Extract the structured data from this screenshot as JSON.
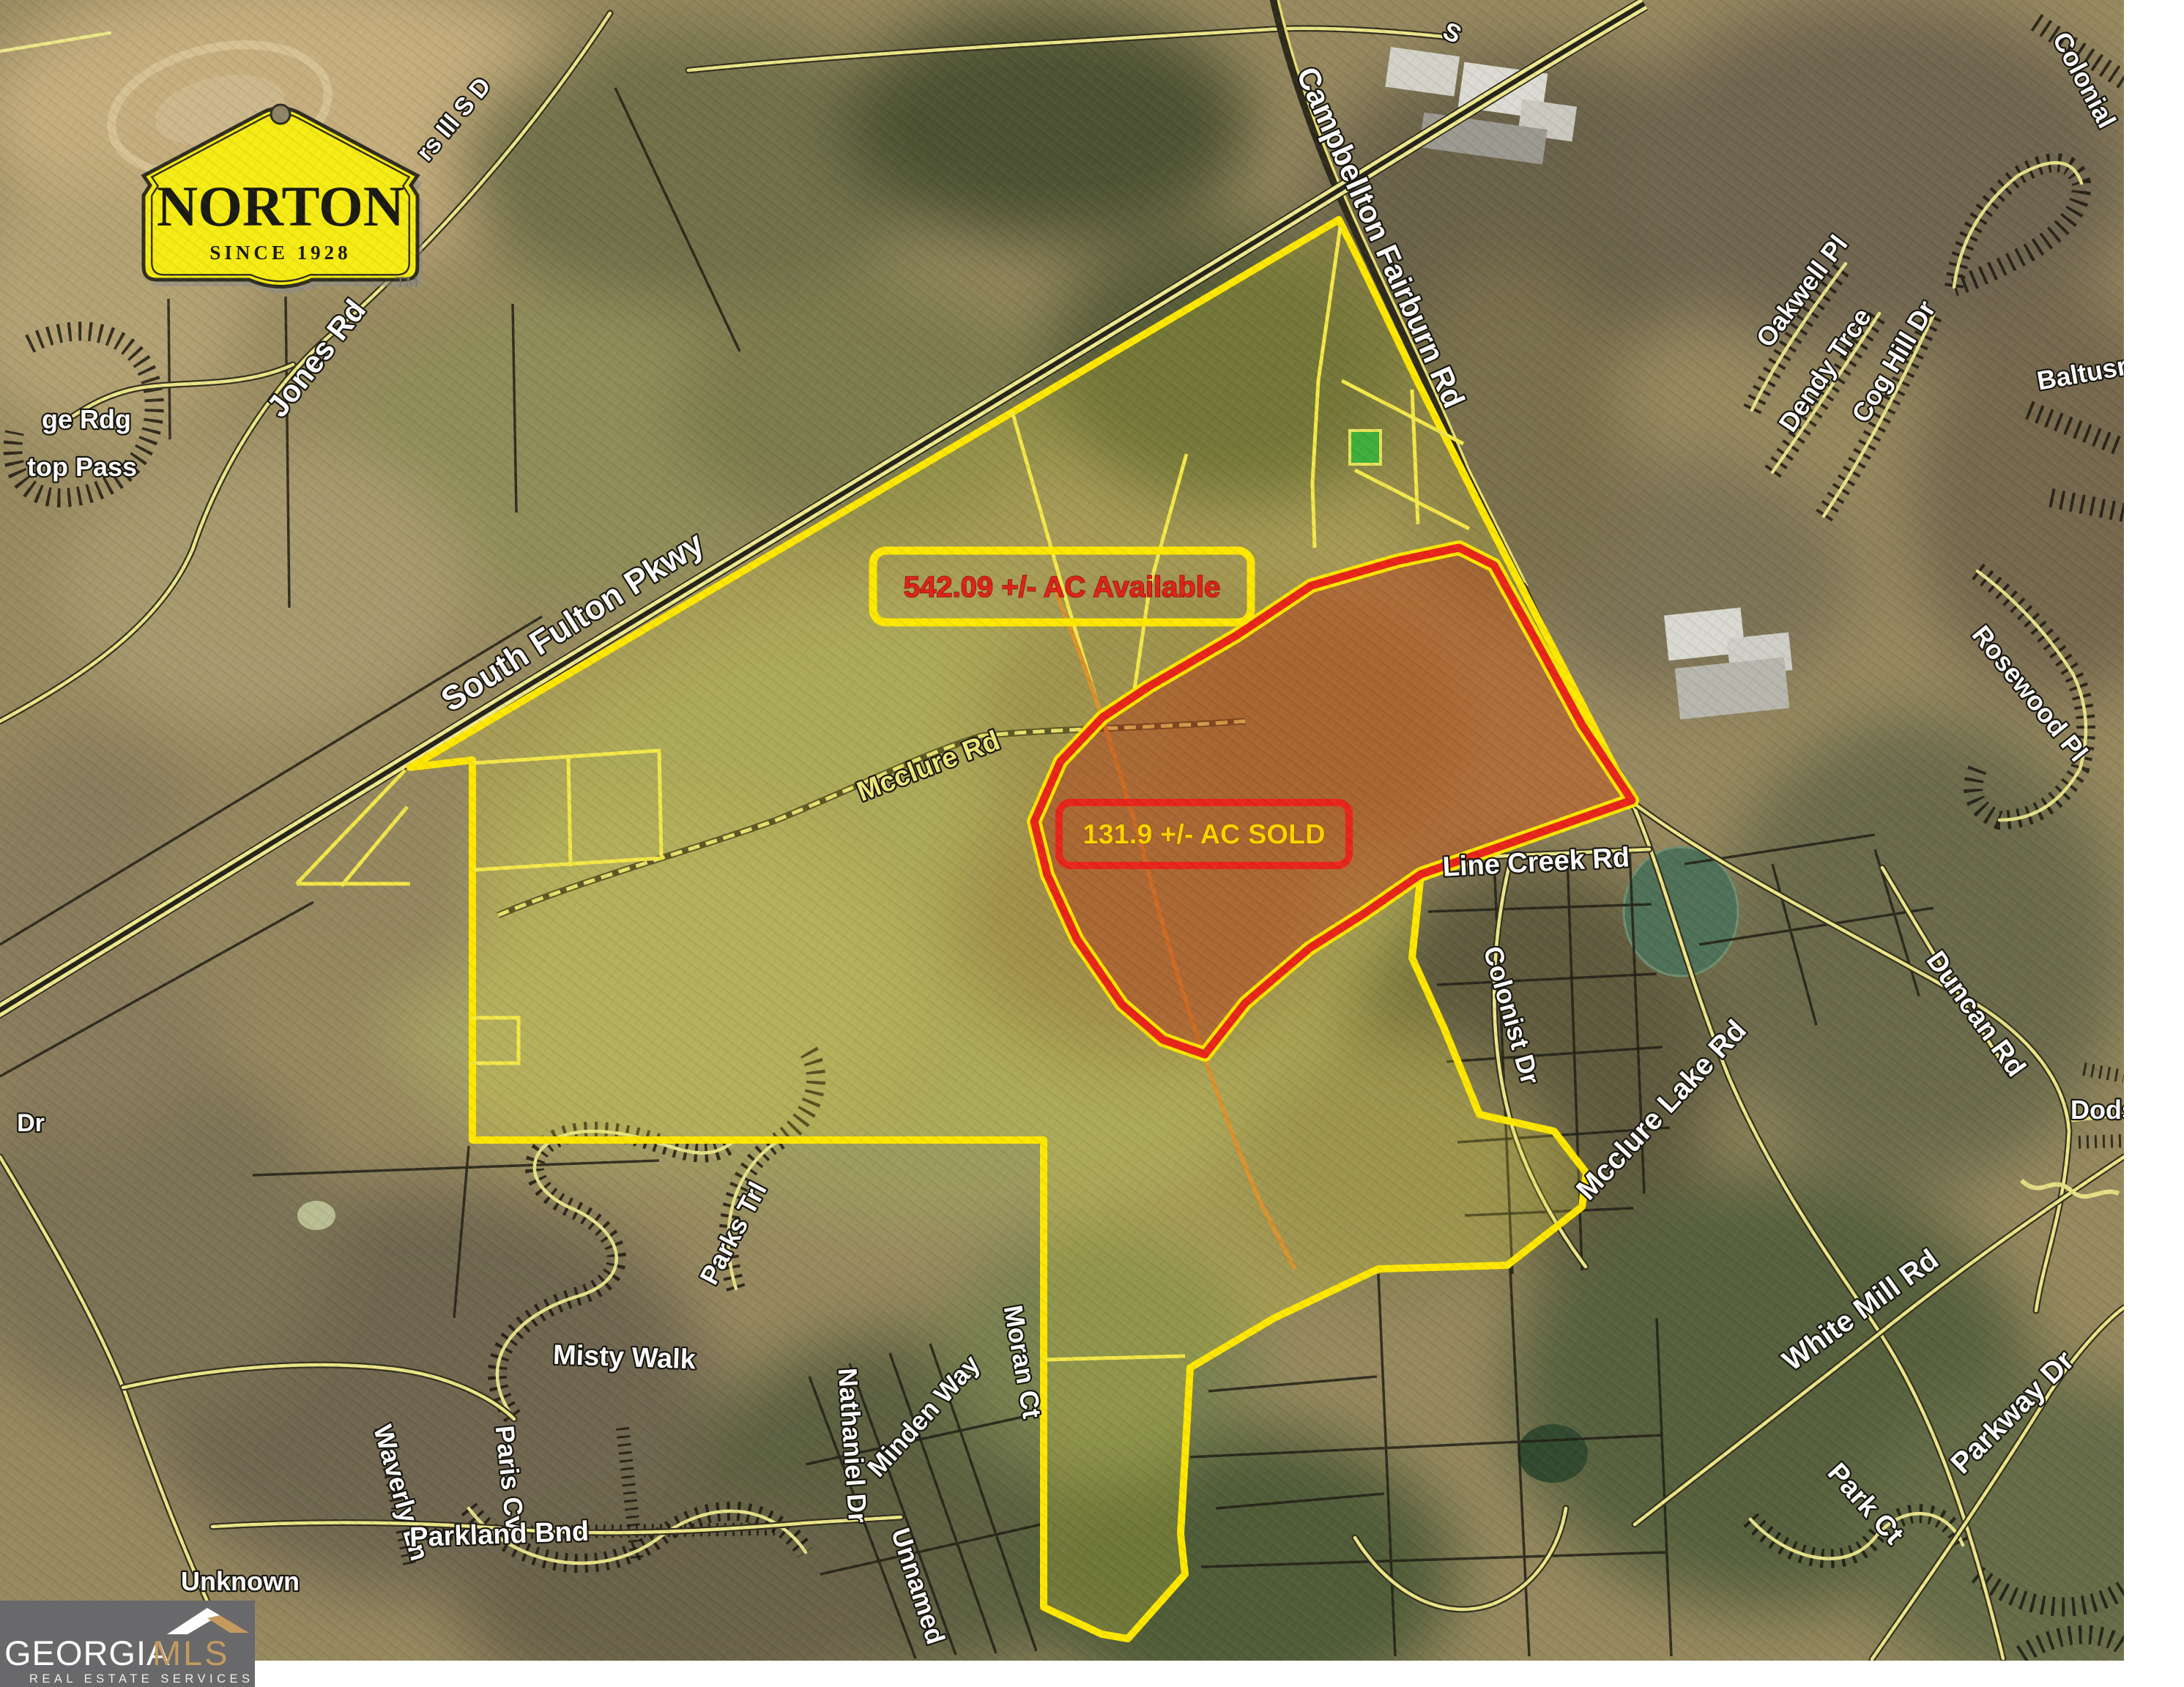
{
  "branding": {
    "norton": {
      "name": "NORTON",
      "since": "SINCE 1928",
      "trademark": "TM",
      "sign_color": "#f7ec13"
    },
    "georgia_mls": {
      "brand_white": "GEORGIA",
      "brand_gold": "MLS",
      "tagline": "REAL ESTATE SERVICES",
      "panel_color": "#69686a",
      "gold_color": "#c49a5f"
    }
  },
  "parcels": {
    "available": {
      "label": "542.09 +/- AC Available",
      "outline_color": "#ffe800",
      "text_color": "#de2318"
    },
    "sold": {
      "label": "131.9 +/- AC SOLD",
      "outline_color": "#e8251a",
      "text_color": "#ffd400"
    }
  },
  "road_labels": {
    "jones_rd": "Jones Rd",
    "hill_sd_fragment": "rs Ill S D",
    "south_fulton_pkwy": "South Fulton Pkwy",
    "s_fragment": "S",
    "campbellton_fairburn_rd": "Campbellton Fairburn Rd",
    "mcclure_rd": "Mcclure Rd",
    "line_creek_rd": "Line Creek Rd",
    "colonist_dr": "Colonist Dr",
    "mcclure_lake_rd": "Mcclure Lake Rd",
    "oakwell_pl": "Oakwell Pl",
    "dendy_trce": "Dendy Trce",
    "cog_hill_dr": "Cog Hill Dr",
    "baltusrol_fragment": "Baltusr",
    "colonial_fragment": "Colonial",
    "rosewood_pl": "Rosewood Pl",
    "duncan_rd": "Duncan Rd",
    "dodson_fragment": "Dods",
    "white_mill_rd": "White Mill Rd",
    "parkway_dr": "Parkway Dr",
    "park_ct": "Park Ct",
    "misty_walk": "Misty Walk",
    "parks_trl": "Parks Trl",
    "waverly_ln": "Waverly Ln",
    "paris_cv": "Paris Cv",
    "parkland_bnd": "Parkland Bnd",
    "unknown": "Unknown",
    "nathaniel_dr": "Nathaniel Dr",
    "minden_way": "Minden Way",
    "moran_ct": "Moran Ct",
    "unnamed": "Unnamed",
    "rdg_fragment": "ge Rdg",
    "pass_fragment": "top Pass",
    "dr_fragment": "Dr"
  }
}
